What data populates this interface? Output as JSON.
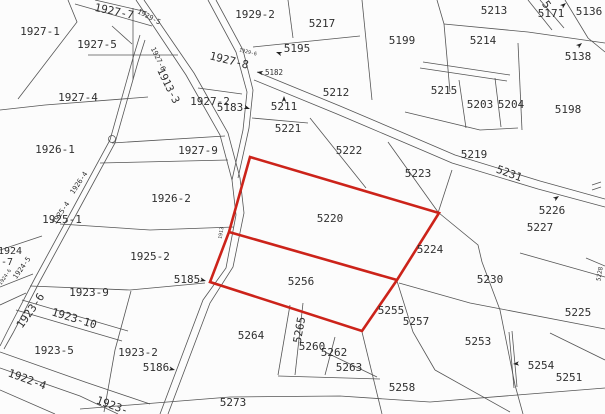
{
  "map": {
    "type": "cadastral-parcel-map",
    "background": "#fcfcfc",
    "line_color": "#555555",
    "label_color": "#2f2f2f",
    "highlight_color": "#cc231a",
    "highlighted_parcels": [
      "5220",
      "5256"
    ],
    "red_polygon": [
      [
        250,
        157
      ],
      [
        439,
        213
      ],
      [
        397,
        280
      ],
      [
        362,
        331
      ],
      [
        210,
        282
      ],
      [
        229,
        232
      ]
    ],
    "red_divider": [
      [
        229,
        232
      ],
      [
        397,
        280
      ]
    ],
    "labels": [
      {
        "t": "1927-1",
        "x": 40,
        "y": 32,
        "r": 0,
        "s": 11
      },
      {
        "t": "1927-5",
        "x": 97,
        "y": 45,
        "r": 0,
        "s": 11
      },
      {
        "t": "1927-4",
        "x": 78,
        "y": 98,
        "r": 0,
        "s": 11
      },
      {
        "t": "1927-7",
        "x": 114,
        "y": 12,
        "r": 12,
        "s": 11
      },
      {
        "t": "1929-5",
        "x": 149,
        "y": 17,
        "r": 28,
        "s": 7
      },
      {
        "t": "1927-6",
        "x": 158,
        "y": 59,
        "r": 64,
        "s": 7
      },
      {
        "t": "1913-3",
        "x": 168,
        "y": 86,
        "r": 64,
        "s": 10.5
      },
      {
        "t": "1927-8",
        "x": 229,
        "y": 61,
        "r": 14,
        "s": 11
      },
      {
        "t": "1929-6",
        "x": 248,
        "y": 52,
        "r": 14,
        "s": 5
      },
      {
        "t": "1929-2",
        "x": 255,
        "y": 15,
        "r": 0,
        "s": 11
      },
      {
        "t": "5217",
        "x": 322,
        "y": 24,
        "r": 0,
        "s": 11
      },
      {
        "t": "5195",
        "x": 297,
        "y": 49,
        "r": 0,
        "s": 11
      },
      {
        "t": "5182",
        "x": 274,
        "y": 73,
        "r": 0,
        "s": 7.5
      },
      {
        "t": "5212",
        "x": 336,
        "y": 93,
        "r": 0,
        "s": 11
      },
      {
        "t": "1927-2",
        "x": 210,
        "y": 102,
        "r": 0,
        "s": 11
      },
      {
        "t": "5183",
        "x": 230,
        "y": 108,
        "r": 0,
        "s": 11
      },
      {
        "t": "5211",
        "x": 284,
        "y": 107,
        "r": 0,
        "s": 11
      },
      {
        "t": "5221",
        "x": 288,
        "y": 129,
        "r": 0,
        "s": 11
      },
      {
        "t": "1927-9",
        "x": 198,
        "y": 151,
        "r": 0,
        "s": 11
      },
      {
        "t": "5222",
        "x": 349,
        "y": 151,
        "r": 0,
        "s": 11
      },
      {
        "t": "5223",
        "x": 418,
        "y": 174,
        "r": 0,
        "s": 11
      },
      {
        "t": "5219",
        "x": 474,
        "y": 155,
        "r": 0,
        "s": 11
      },
      {
        "t": "5231",
        "x": 509,
        "y": 174,
        "r": 20,
        "s": 11
      },
      {
        "t": "5199",
        "x": 402,
        "y": 41,
        "r": 0,
        "s": 11
      },
      {
        "t": "5213",
        "x": 494,
        "y": 11,
        "r": 0,
        "s": 11
      },
      {
        "t": "5214",
        "x": 483,
        "y": 41,
        "r": 0,
        "s": 11
      },
      {
        "t": "5215",
        "x": 444,
        "y": 91,
        "r": 0,
        "s": 11
      },
      {
        "t": "5203",
        "x": 480,
        "y": 105,
        "r": 0,
        "s": 11
      },
      {
        "t": "5204",
        "x": 511,
        "y": 105,
        "r": 0,
        "s": 11
      },
      {
        "t": "5198",
        "x": 568,
        "y": 110,
        "r": 0,
        "s": 11
      },
      {
        "t": "5171",
        "x": 551,
        "y": 14,
        "r": 0,
        "s": 11
      },
      {
        "t": "5136",
        "x": 589,
        "y": 12,
        "r": 0,
        "s": 11
      },
      {
        "t": "5138",
        "x": 578,
        "y": 57,
        "r": 0,
        "s": 11
      },
      {
        "t": "5",
        "x": 546,
        "y": 5,
        "r": 55,
        "s": 11
      },
      {
        "t": "1926-1",
        "x": 55,
        "y": 150,
        "r": 0,
        "s": 11
      },
      {
        "t": "1926-2",
        "x": 171,
        "y": 199,
        "r": 0,
        "s": 11
      },
      {
        "t": "1926-4",
        "x": 79,
        "y": 183,
        "r": -56,
        "s": 7
      },
      {
        "t": "1925-4",
        "x": 61,
        "y": 213,
        "r": -56,
        "s": 7
      },
      {
        "t": "1925-1",
        "x": 62,
        "y": 220,
        "r": 0,
        "s": 11
      },
      {
        "t": "1924",
        "x": 10,
        "y": 251,
        "r": 0,
        "s": 10
      },
      {
        "t": "-7",
        "x": 7,
        "y": 262,
        "r": 0,
        "s": 10
      },
      {
        "t": "1924-5",
        "x": 22,
        "y": 268,
        "r": -55,
        "s": 7
      },
      {
        "t": "1924-6",
        "x": 5,
        "y": 277,
        "r": -55,
        "s": 5
      },
      {
        "t": "1925-2",
        "x": 150,
        "y": 257,
        "r": 0,
        "s": 11
      },
      {
        "t": "5185",
        "x": 187,
        "y": 280,
        "r": 0,
        "s": 11
      },
      {
        "t": "1923-9",
        "x": 89,
        "y": 293,
        "r": 0,
        "s": 11
      },
      {
        "t": "1923-6",
        "x": 31,
        "y": 311,
        "r": -55,
        "s": 11
      },
      {
        "t": "1923-10",
        "x": 74,
        "y": 319,
        "r": 17,
        "s": 11
      },
      {
        "t": "1923-5",
        "x": 54,
        "y": 351,
        "r": 0,
        "s": 11
      },
      {
        "t": "1923-2",
        "x": 138,
        "y": 353,
        "r": 0,
        "s": 11
      },
      {
        "t": "5186",
        "x": 156,
        "y": 368,
        "r": 0,
        "s": 11
      },
      {
        "t": "1922-4",
        "x": 27,
        "y": 380,
        "r": 20,
        "s": 11
      },
      {
        "t": "1923-",
        "x": 112,
        "y": 406,
        "r": 20,
        "s": 11
      },
      {
        "t": "5273",
        "x": 233,
        "y": 403,
        "r": 0,
        "s": 11
      },
      {
        "t": "5264",
        "x": 251,
        "y": 336,
        "r": 0,
        "s": 11
      },
      {
        "t": "5265",
        "x": 300,
        "y": 330,
        "r": -80,
        "s": 11
      },
      {
        "t": "5260",
        "x": 312,
        "y": 347,
        "r": 0,
        "s": 11
      },
      {
        "t": "5262",
        "x": 334,
        "y": 353,
        "r": 0,
        "s": 11
      },
      {
        "t": "5263",
        "x": 349,
        "y": 368,
        "r": 0,
        "s": 11
      },
      {
        "t": "5255",
        "x": 391,
        "y": 311,
        "r": 0,
        "s": 11
      },
      {
        "t": "5256",
        "x": 301,
        "y": 282,
        "r": 0,
        "s": 11
      },
      {
        "t": "5220",
        "x": 330,
        "y": 219,
        "r": 0,
        "s": 11
      },
      {
        "t": "5224",
        "x": 430,
        "y": 250,
        "r": 0,
        "s": 11
      },
      {
        "t": "5230",
        "x": 490,
        "y": 280,
        "r": 0,
        "s": 11
      },
      {
        "t": "5257",
        "x": 416,
        "y": 322,
        "r": 0,
        "s": 11
      },
      {
        "t": "5253",
        "x": 478,
        "y": 342,
        "r": 0,
        "s": 11
      },
      {
        "t": "5254",
        "x": 541,
        "y": 366,
        "r": 0,
        "s": 11
      },
      {
        "t": "5251",
        "x": 569,
        "y": 378,
        "r": 0,
        "s": 11
      },
      {
        "t": "5225",
        "x": 578,
        "y": 313,
        "r": 0,
        "s": 11
      },
      {
        "t": "5258",
        "x": 402,
        "y": 388,
        "r": 0,
        "s": 11
      },
      {
        "t": "5226",
        "x": 552,
        "y": 211,
        "r": 0,
        "s": 11
      },
      {
        "t": "5227",
        "x": 540,
        "y": 228,
        "r": 0,
        "s": 11
      },
      {
        "t": "5228",
        "x": 600,
        "y": 274,
        "r": -80,
        "s": 6
      },
      {
        "t": "1913",
        "x": 221,
        "y": 233,
        "r": -80,
        "s": 5
      }
    ],
    "lines": [
      [
        [
          136,
          0
        ],
        [
          186,
          75
        ],
        [
          220,
          135
        ],
        [
          232,
          180
        ],
        [
          236,
          215
        ],
        [
          226,
          268
        ],
        [
          203,
          300
        ],
        [
          186,
          345
        ],
        [
          160,
          414
        ]
      ],
      [
        [
          144,
          0
        ],
        [
          194,
          73
        ],
        [
          228,
          133
        ],
        [
          240,
          178
        ],
        [
          244,
          213
        ],
        [
          233,
          267
        ],
        [
          210,
          303
        ],
        [
          193,
          348
        ],
        [
          168,
          414
        ]
      ],
      [
        [
          208,
          0
        ],
        [
          236,
          52
        ],
        [
          247,
          92
        ],
        [
          243,
          130
        ],
        [
          232,
          180
        ]
      ],
      [
        [
          216,
          0
        ],
        [
          243,
          50
        ],
        [
          253,
          90
        ],
        [
          249,
          128
        ],
        [
          238,
          178
        ]
      ],
      [
        [
          140,
          35
        ],
        [
          133,
          58
        ],
        [
          110,
          140
        ],
        [
          72,
          210
        ],
        [
          35,
          278
        ],
        [
          8,
          330
        ],
        [
          0,
          346
        ]
      ],
      [
        [
          145,
          40
        ],
        [
          138,
          62
        ],
        [
          115,
          143
        ],
        [
          77,
          213
        ],
        [
          40,
          281
        ],
        [
          13,
          333
        ],
        [
          4,
          349
        ]
      ],
      [
        [
          257,
          72
        ],
        [
          340,
          106
        ],
        [
          420,
          140
        ],
        [
          455,
          155
        ],
        [
          540,
          181
        ],
        [
          605,
          199
        ]
      ],
      [
        [
          254,
          80
        ],
        [
          337,
          114
        ],
        [
          417,
          148
        ],
        [
          452,
          163
        ],
        [
          538,
          189
        ],
        [
          605,
          207
        ]
      ],
      [
        [
          68,
          0
        ],
        [
          77,
          22
        ],
        [
          18,
          99
        ]
      ],
      [
        [
          0,
          110
        ],
        [
          45,
          105
        ],
        [
          148,
          97
        ]
      ],
      [
        [
          75,
          4
        ],
        [
          152,
          26
        ]
      ],
      [
        [
          95,
          0
        ],
        [
          147,
          12
        ]
      ],
      [
        [
          133,
          8
        ],
        [
          133,
          80
        ]
      ],
      [
        [
          88,
          55
        ],
        [
          178,
          55
        ]
      ],
      [
        [
          112,
          26
        ],
        [
          132,
          44
        ]
      ],
      [
        [
          112,
          143
        ],
        [
          225,
          136
        ]
      ],
      [
        [
          100,
          163
        ],
        [
          228,
          160
        ]
      ],
      [
        [
          60,
          224
        ],
        [
          150,
          230
        ],
        [
          234,
          227
        ]
      ],
      [
        [
          30,
          286
        ],
        [
          130,
          290
        ],
        [
          205,
          283
        ]
      ],
      [
        [
          0,
          250
        ],
        [
          42,
          236
        ]
      ],
      [
        [
          0,
          287
        ],
        [
          33,
          274
        ]
      ],
      [
        [
          0,
          305
        ],
        [
          26,
          293
        ]
      ],
      [
        [
          22,
          300
        ],
        [
          128,
          331
        ]
      ],
      [
        [
          16,
          310
        ],
        [
          122,
          341
        ]
      ],
      [
        [
          131,
          291
        ],
        [
          115,
          350
        ],
        [
          104,
          412
        ]
      ],
      [
        [
          0,
          352
        ],
        [
          85,
          382
        ],
        [
          150,
          404
        ]
      ],
      [
        [
          0,
          368
        ],
        [
          80,
          396
        ],
        [
          118,
          414
        ]
      ],
      [
        [
          0,
          390
        ],
        [
          55,
          414
        ]
      ],
      [
        [
          80,
          409
        ],
        [
          230,
          397
        ],
        [
          340,
          396
        ],
        [
          430,
          402
        ],
        [
          605,
          388
        ]
      ],
      [
        [
          290,
          305
        ],
        [
          278,
          375
        ]
      ],
      [
        [
          303,
          303
        ],
        [
          295,
          375
        ]
      ],
      [
        [
          335,
          337
        ],
        [
          325,
          375
        ]
      ],
      [
        [
          325,
          352
        ],
        [
          377,
          377
        ]
      ],
      [
        [
          278,
          376
        ],
        [
          380,
          379
        ]
      ],
      [
        [
          397,
          281
        ],
        [
          413,
          332
        ],
        [
          435,
          370
        ]
      ],
      [
        [
          362,
          332
        ],
        [
          382,
          414
        ]
      ],
      [
        [
          435,
          370
        ],
        [
          510,
          412
        ]
      ],
      [
        [
          509,
          332
        ],
        [
          514,
          388
        ]
      ],
      [
        [
          512,
          331
        ],
        [
          517,
          387
        ]
      ],
      [
        [
          399,
          283
        ],
        [
          470,
          303
        ],
        [
          605,
          329
        ]
      ],
      [
        [
          520,
          253
        ],
        [
          605,
          277
        ]
      ],
      [
        [
          482,
          262
        ],
        [
          500,
          310
        ],
        [
          515,
          385
        ],
        [
          523,
          414
        ]
      ],
      [
        [
          550,
          333
        ],
        [
          605,
          360
        ]
      ],
      [
        [
          439,
          213
        ],
        [
          478,
          245
        ],
        [
          482,
          262
        ]
      ],
      [
        [
          452,
          170
        ],
        [
          438,
          213
        ]
      ],
      [
        [
          388,
          142
        ],
        [
          438,
          212
        ]
      ],
      [
        [
          310,
          118
        ],
        [
          366,
          188
        ]
      ],
      [
        [
          252,
          118
        ],
        [
          308,
          123
        ]
      ],
      [
        [
          198,
          88
        ],
        [
          242,
          94
        ]
      ],
      [
        [
          253,
          47
        ],
        [
          360,
          36
        ]
      ],
      [
        [
          288,
          0
        ],
        [
          293,
          38
        ]
      ],
      [
        [
          362,
          0
        ],
        [
          372,
          100
        ]
      ],
      [
        [
          437,
          0
        ],
        [
          444,
          24
        ],
        [
          450,
          92
        ]
      ],
      [
        [
          444,
          24
        ],
        [
          528,
          32
        ]
      ],
      [
        [
          528,
          32
        ],
        [
          605,
          43
        ]
      ],
      [
        [
          423,
          62
        ],
        [
          510,
          75
        ]
      ],
      [
        [
          420,
          68
        ],
        [
          507,
          81
        ]
      ],
      [
        [
          459,
          80
        ],
        [
          466,
          128
        ]
      ],
      [
        [
          495,
          78
        ],
        [
          501,
          127
        ]
      ],
      [
        [
          518,
          43
        ],
        [
          522,
          130
        ]
      ],
      [
        [
          405,
          112
        ],
        [
          480,
          130
        ],
        [
          518,
          128
        ]
      ],
      [
        [
          565,
          0
        ],
        [
          588,
          38
        ],
        [
          605,
          52
        ]
      ],
      [
        [
          528,
          0
        ],
        [
          552,
          30
        ]
      ],
      [
        [
          540,
          0
        ],
        [
          564,
          28
        ]
      ],
      [
        [
          592,
          185
        ],
        [
          601,
          182
        ]
      ],
      [
        [
          592,
          190
        ],
        [
          601,
          187
        ]
      ],
      [
        [
          586,
          258
        ],
        [
          605,
          266
        ]
      ]
    ],
    "markers": [
      {
        "x": 276,
        "y": 52,
        "a": 200
      },
      {
        "x": 257,
        "y": 72,
        "a": 190
      },
      {
        "x": 250,
        "y": 109,
        "a": 20
      },
      {
        "x": 284,
        "y": 96,
        "a": -90
      },
      {
        "x": 206,
        "y": 281,
        "a": 15
      },
      {
        "x": 175,
        "y": 370,
        "a": 15
      },
      {
        "x": 559,
        "y": 196,
        "a": -35
      },
      {
        "x": 513,
        "y": 364,
        "a": 175
      },
      {
        "x": 582,
        "y": 43,
        "a": -40
      },
      {
        "x": 566,
        "y": 3,
        "a": -40
      }
    ],
    "circles": [
      {
        "x": 112,
        "y": 139,
        "r": 3.5
      }
    ]
  }
}
